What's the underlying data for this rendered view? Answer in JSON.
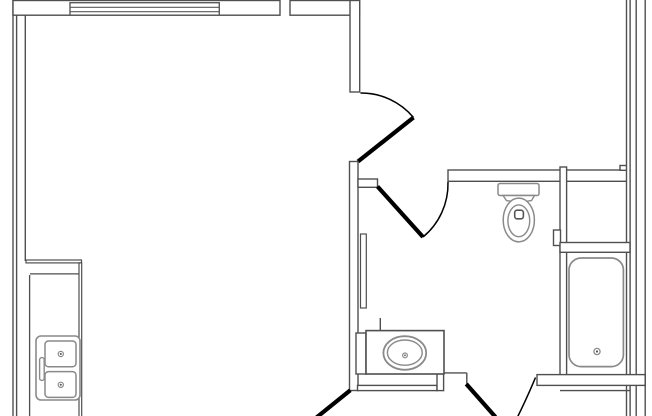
{
  "canvas": {
    "width": 652,
    "height": 416
  },
  "colors": {
    "wall": "#4f4f4f",
    "door": "#000000",
    "fixture": "#8a8a8a",
    "window": "#5a5a5a",
    "dot": "#555555",
    "background": "#ffffff"
  },
  "plan": {
    "description": "apartment floor plan",
    "rooms": [
      "living-kitchen",
      "entry",
      "bathroom",
      "toilet-room",
      "tub-alcove",
      "hall"
    ]
  },
  "elements": [
    {
      "name": "left-outer-wall",
      "type": "rect",
      "x": 13,
      "y": -2,
      "w": 3.6,
      "h": 420
    },
    {
      "name": "top-wall-left",
      "type": "rect",
      "x": 13,
      "y": 0.5,
      "w": 267,
      "h": 14.7
    },
    {
      "name": "top-wall-right",
      "type": "rect",
      "x": 290,
      "y": 0.5,
      "w": 69.5,
      "h": 14.7
    },
    {
      "name": "window",
      "type": "rect",
      "x": 70,
      "y": 2.7,
      "w": 149.3,
      "h": 12.5,
      "c": "window",
      "w2": 1.4
    },
    {
      "name": "window-glazing-line-1",
      "type": "line",
      "x1": 70,
      "y1": 7.3,
      "x2": 219.3,
      "y2": 7.3,
      "c": "window",
      "w2": 1.2
    },
    {
      "name": "window-glazing-line-2",
      "type": "line",
      "x1": 70,
      "y1": 11.7,
      "x2": 219.3,
      "y2": 11.7,
      "c": "window",
      "w2": 1.2
    },
    {
      "name": "left-inner-wall-line",
      "type": "line",
      "x1": 25.3,
      "y1": 15.2,
      "x2": 25.3,
      "y2": 261,
      "w2": 1.4
    },
    {
      "name": "entry-wall",
      "type": "rect",
      "x": 350,
      "y": 0.5,
      "w": 9.7,
      "h": 91.5
    },
    {
      "name": "entry-door-arc",
      "type": "path",
      "d": "M 360.5 93 A 68 68 0 0 1 413.5 117.5",
      "c": "door",
      "w2": 1.5
    },
    {
      "name": "entry-door-leaf",
      "type": "line",
      "x1": 413.5,
      "y1": 117.5,
      "x2": 358,
      "y2": 161.5,
      "c": "door",
      "w2": 4.2
    },
    {
      "name": "hall-wall",
      "type": "rect",
      "x": 349.5,
      "y": 161.5,
      "w": 8.5,
      "h": 229
    },
    {
      "name": "bath-door-stub",
      "type": "rect",
      "x": 358,
      "y": 179,
      "w": 19.5,
      "h": 8.3
    },
    {
      "name": "bath-door-leaf",
      "type": "line",
      "x1": 377.5,
      "y1": 186.5,
      "x2": 423,
      "y2": 237,
      "c": "door",
      "w2": 4.2
    },
    {
      "name": "bath-door-arc",
      "type": "path",
      "d": "M 448 182 A 69 69 0 0 1 423 237",
      "c": "door",
      "w2": 1.5
    },
    {
      "name": "pocket-door-panel",
      "type": "rect",
      "x": 360.5,
      "y": 234,
      "w": 5.8,
      "h": 74,
      "w2": 1.2
    },
    {
      "name": "toilet-room-top-wall",
      "type": "rect",
      "x": 448,
      "y": 170,
      "w": 179,
      "h": 11.3
    },
    {
      "name": "wall-notch",
      "type": "rect",
      "x": 620,
      "y": 165.5,
      "w": 6.8,
      "h": 4.8
    },
    {
      "name": "interior-right-wall",
      "type": "rect",
      "x": 626.5,
      "y": -2,
      "w": 3.6,
      "h": 420
    },
    {
      "name": "outer-right-wall",
      "type": "rect",
      "x": 636.2,
      "y": -2,
      "w": 9,
      "h": 420
    },
    {
      "name": "divider-wall",
      "type": "rect",
      "x": 560,
      "y": 167,
      "w": 6.6,
      "h": 210
    },
    {
      "name": "wall-mounted-fixture",
      "type": "rect",
      "x": 553.5,
      "y": 230,
      "w": 7,
      "h": 15.5
    },
    {
      "name": "closet-bottom-wall",
      "type": "rect",
      "x": 560,
      "y": 242.5,
      "w": 70,
      "h": 9.8
    },
    {
      "name": "tub-south-wall",
      "type": "rect",
      "x": 537,
      "y": 374.6,
      "w": 108.2,
      "h": 10.8
    },
    {
      "name": "lower-wall-line",
      "type": "line",
      "x1": 560,
      "y1": 390.6,
      "x2": 630,
      "y2": 390.6,
      "w2": 1.4
    },
    {
      "name": "hall-band-wall",
      "type": "rect",
      "x": 357.5,
      "y": 385.4,
      "w": 79.5,
      "h": 5.2
    },
    {
      "name": "hall-corner-wall",
      "type": "rect",
      "x": 437,
      "y": 373.8,
      "w": 6.6,
      "h": 16.8
    },
    {
      "name": "counter-right-line",
      "type": "line",
      "x1": 444,
      "y1": 372.9,
      "x2": 466.8,
      "y2": 372.9,
      "w2": 1.4
    },
    {
      "name": "door3-jamb-line",
      "type": "line",
      "x1": 466.8,
      "y1": 372.9,
      "x2": 466.8,
      "y2": 384.5,
      "w2": 1.4
    },
    {
      "name": "door3-leaf",
      "type": "line",
      "x1": 466.3,
      "y1": 384,
      "x2": 495.5,
      "y2": 417,
      "c": "door",
      "w2": 4.2
    },
    {
      "name": "door3-arc",
      "type": "path",
      "d": "M 535.5 377.5 Q 526.5 399 517.5 417",
      "c": "door",
      "w2": 1.5
    },
    {
      "name": "door4-leaf",
      "type": "line",
      "x1": 350.3,
      "y1": 390.2,
      "x2": 316.5,
      "y2": 417.5,
      "c": "door",
      "w2": 4.2
    },
    {
      "name": "vanity-stub-line",
      "type": "line",
      "x1": 380.3,
      "y1": 318,
      "x2": 380.3,
      "y2": 330.6,
      "w2": 1.4
    },
    {
      "name": "vanity-filler",
      "type": "rect",
      "x": 356,
      "y": 333,
      "w": 10,
      "h": 41
    },
    {
      "name": "vanity-counter",
      "type": "rect",
      "x": 366,
      "y": 330.6,
      "w": 78,
      "h": 43.4,
      "w2": 1.6
    },
    {
      "name": "vanity-sink-outer",
      "type": "ellipse",
      "cx": 404.8,
      "cy": 353,
      "rx": 21.4,
      "ry": 16.8,
      "c": "fixture",
      "w2": 1.8
    },
    {
      "name": "vanity-sink-inner",
      "type": "ellipse",
      "cx": 404.8,
      "cy": 352.6,
      "rx": 17.4,
      "ry": 12.6,
      "c": "fixture",
      "w2": 1.4
    },
    {
      "name": "vanity-sink-drain",
      "type": "circle",
      "cx": 405,
      "cy": 355.4,
      "r": 2.4,
      "c": "fixture",
      "w2": 1.2
    },
    {
      "name": "vanity-sink-drain-dot",
      "type": "circle",
      "cx": 405,
      "cy": 355.4,
      "r": 0.9,
      "f": "#555555"
    },
    {
      "name": "toilet-tank",
      "type": "rect",
      "x": 498,
      "y": 183.5,
      "w": 41,
      "h": 12,
      "rx": 2,
      "c": "fixture",
      "w2": 1.5
    },
    {
      "name": "toilet-neck",
      "type": "path",
      "d": "M 503 195.5 L 534.5 195.5 L 531.5 200.6 Q 519 202.8 506.5 200.6 Z",
      "c": "fixture",
      "f": "white",
      "w2": 1.4
    },
    {
      "name": "toilet-bowl",
      "type": "ellipse",
      "cx": 518.8,
      "cy": 220,
      "rx": 15.6,
      "ry": 21.9,
      "c": "fixture",
      "w2": 1.5
    },
    {
      "name": "toilet-seat",
      "type": "ellipse",
      "cx": 518.8,
      "cy": 220.8,
      "rx": 10.9,
      "ry": 15.9,
      "c": "fixture",
      "w2": 1.4
    },
    {
      "name": "toilet-flush-button",
      "type": "rect",
      "x": 514.7,
      "y": 210.2,
      "w": 8.7,
      "h": 8.6,
      "rx": 2.4,
      "c": "dot",
      "w2": 1.6
    },
    {
      "name": "bathtub",
      "type": "rect",
      "x": 569,
      "y": 258,
      "w": 54.4,
      "h": 108.6,
      "rx": 12,
      "c": "fixture",
      "w2": 1.7
    },
    {
      "name": "bathtub-drain",
      "type": "circle",
      "cx": 597,
      "cy": 351.5,
      "r": 3.1,
      "c": "fixture",
      "w2": 1.3
    },
    {
      "name": "bathtub-drain-dot",
      "type": "circle",
      "cx": 597,
      "cy": 351.5,
      "r": 1.1,
      "f": "#555555"
    },
    {
      "name": "kitchen-counter-top-band",
      "type": "rect",
      "x": 26,
      "y": 260,
      "w": 55.5,
      "h": 2.9,
      "w2": 1.2
    },
    {
      "name": "kitchen-counter-front-band",
      "type": "rect",
      "x": 79,
      "y": 262.9,
      "w": 2.7,
      "h": 155,
      "w2": 1.2
    },
    {
      "name": "kitchen-counter-inner-h",
      "type": "line",
      "x1": 30,
      "y1": 273.9,
      "x2": 79,
      "y2": 273.9,
      "w2": 1.3
    },
    {
      "name": "kitchen-counter-inner-v",
      "type": "line",
      "x1": 29.6,
      "y1": 275,
      "x2": 29.6,
      "y2": 417,
      "w2": 1.3
    },
    {
      "name": "kitchen-sink-outer",
      "type": "rect",
      "x": 36,
      "y": 336,
      "w": 44,
      "h": 64,
      "rx": 5,
      "c": "fixture",
      "w2": 1.6
    },
    {
      "name": "kitchen-sink-bowl-1",
      "type": "rect",
      "x": 45,
      "y": 341,
      "w": 31,
      "h": 25.8,
      "rx": 3.5,
      "c": "fixture",
      "w2": 1.5
    },
    {
      "name": "kitchen-sink-bowl-2",
      "type": "rect",
      "x": 45,
      "y": 371.6,
      "w": 31,
      "h": 25.8,
      "rx": 3.5,
      "c": "fixture",
      "w2": 1.5
    },
    {
      "name": "kitchen-sink-faucet",
      "type": "rect",
      "x": 39.6,
      "y": 357.6,
      "w": 4.6,
      "h": 22.8,
      "rx": 2.2,
      "c": "fixture",
      "w2": 1.4
    },
    {
      "name": "kitchen-sink-drain-1",
      "type": "circle",
      "cx": 60.8,
      "cy": 354,
      "r": 2.6,
      "c": "fixture",
      "w2": 1.2
    },
    {
      "name": "kitchen-sink-drain-1-dot",
      "type": "circle",
      "cx": 60.8,
      "cy": 354,
      "r": 1.0,
      "f": "#555555"
    },
    {
      "name": "kitchen-sink-drain-2",
      "type": "circle",
      "cx": 60.8,
      "cy": 384.8,
      "r": 2.6,
      "c": "fixture",
      "w2": 1.2
    },
    {
      "name": "kitchen-sink-drain-2-dot",
      "type": "circle",
      "cx": 60.8,
      "cy": 384.8,
      "r": 1.0,
      "f": "#555555"
    }
  ]
}
